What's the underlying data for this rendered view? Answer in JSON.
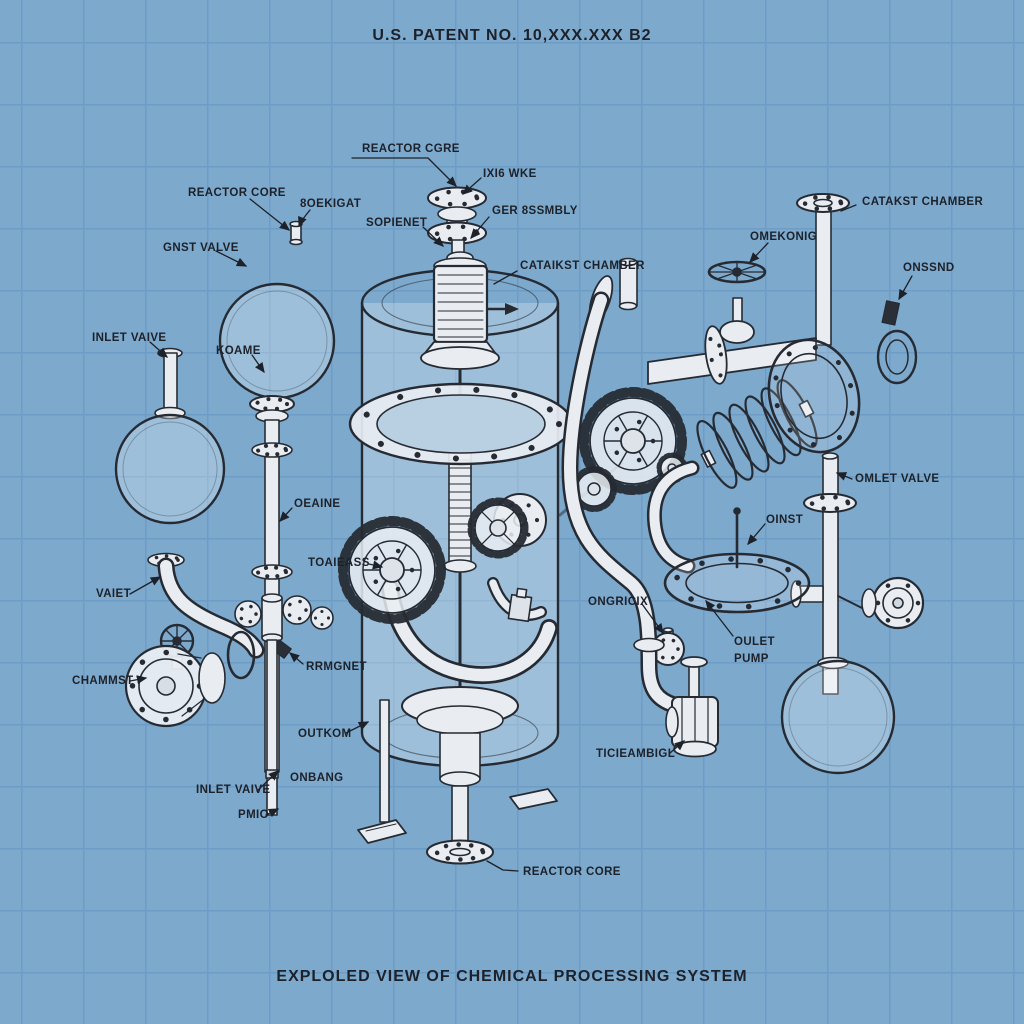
{
  "header": {
    "patent_number": "U.S. PATENT NO. 10,XXX.XXX B2"
  },
  "footer": {
    "caption": "EXPLOLED VIEW OF CHEMICAL PROCESSING SYSTEM"
  },
  "colors": {
    "paper": "#7da9cd",
    "grid": "#6d9cc6",
    "ink": "#1d2129",
    "line": "#262b33",
    "metal": "#e9edf2"
  },
  "labels": [
    {
      "id": "reactor-core-top",
      "text": "REACTOR CGRE"
    },
    {
      "id": "ixi6-wke",
      "text": "IXI6 WKE"
    },
    {
      "id": "ger-assembly",
      "text": "GER 8SSMBLY"
    },
    {
      "id": "sopienet",
      "text": "SOPIENET"
    },
    {
      "id": "reactor-core-left",
      "text": "REACTOR CORE"
    },
    {
      "id": "oekigat",
      "text": "8OEKIGAT"
    },
    {
      "id": "gnst-valve",
      "text": "GNST VALVE"
    },
    {
      "id": "inlet-valve-upper",
      "text": "INLET VAIVE"
    },
    {
      "id": "koame",
      "text": "KOAME"
    },
    {
      "id": "catakst-chamber-right",
      "text": "CATAKST CHAMBER"
    },
    {
      "id": "omekonig",
      "text": "OMEKONIG"
    },
    {
      "id": "onssnd",
      "text": "ONSSND"
    },
    {
      "id": "catakst-chamber-center",
      "text": "CATAIKST CHAMBER"
    },
    {
      "id": "omlet-valve",
      "text": "OMLET VALVE"
    },
    {
      "id": "oinst",
      "text": "OINST"
    },
    {
      "id": "oeaine",
      "text": "OEAINE"
    },
    {
      "id": "toaieass",
      "text": "TOAIEASS"
    },
    {
      "id": "vaiet",
      "text": "VAIET"
    },
    {
      "id": "chammst",
      "text": "CHAMMST"
    },
    {
      "id": "rrmgnet",
      "text": "RRMGNET"
    },
    {
      "id": "outkom",
      "text": "OUTKOM"
    },
    {
      "id": "ongricix",
      "text": "ONGRICIX"
    },
    {
      "id": "oulet-pump-line1",
      "text": "OULET"
    },
    {
      "id": "oulet-pump-line2",
      "text": "PUMP"
    },
    {
      "id": "ticieambigl",
      "text": "TICIEAMBIGL"
    },
    {
      "id": "inlet-valve-lower",
      "text": "INLET VAIVE"
    },
    {
      "id": "onbang",
      "text": "ONBANG"
    },
    {
      "id": "pmio",
      "text": "PMIO"
    },
    {
      "id": "reactor-core-bottom",
      "text": "REACTOR CORE"
    }
  ]
}
